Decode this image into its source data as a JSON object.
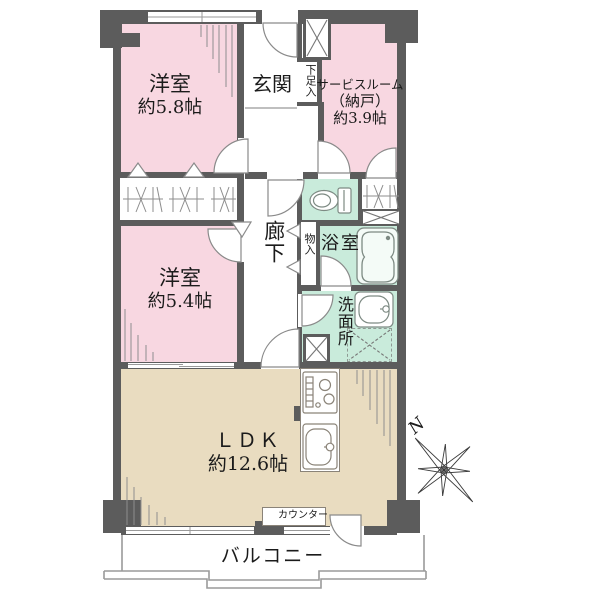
{
  "floorplan": {
    "rooms": {
      "bedroom1": {
        "name": "洋室",
        "area": "約5.8帖"
      },
      "bedroom2": {
        "name": "洋室",
        "area": "約5.4帖"
      },
      "service": {
        "name": "サービスルーム",
        "alias": "（納戸）",
        "area": "約3.9帖"
      },
      "ldk": {
        "name": "ＬＤＫ",
        "area": "約12.6帖"
      },
      "entrance": {
        "label": "玄関"
      },
      "hallway": {
        "label": "廊下"
      },
      "bathroom": {
        "label": "浴室"
      },
      "washroom": {
        "label": "洗面所"
      },
      "balcony": {
        "label": "バルコニー"
      },
      "counter": {
        "label": "カウンター"
      },
      "shoe_cabinet": {
        "label": "下足入"
      },
      "hall_closet": {
        "label": "物入"
      }
    },
    "compass": {
      "north_label": "N"
    },
    "colors": {
      "bedroom_pink": "#f8d7e1",
      "wet_green": "#c9ebdb",
      "ldk_tan": "#e9dcc0",
      "wall_gray": "#5c5c5c"
    }
  }
}
